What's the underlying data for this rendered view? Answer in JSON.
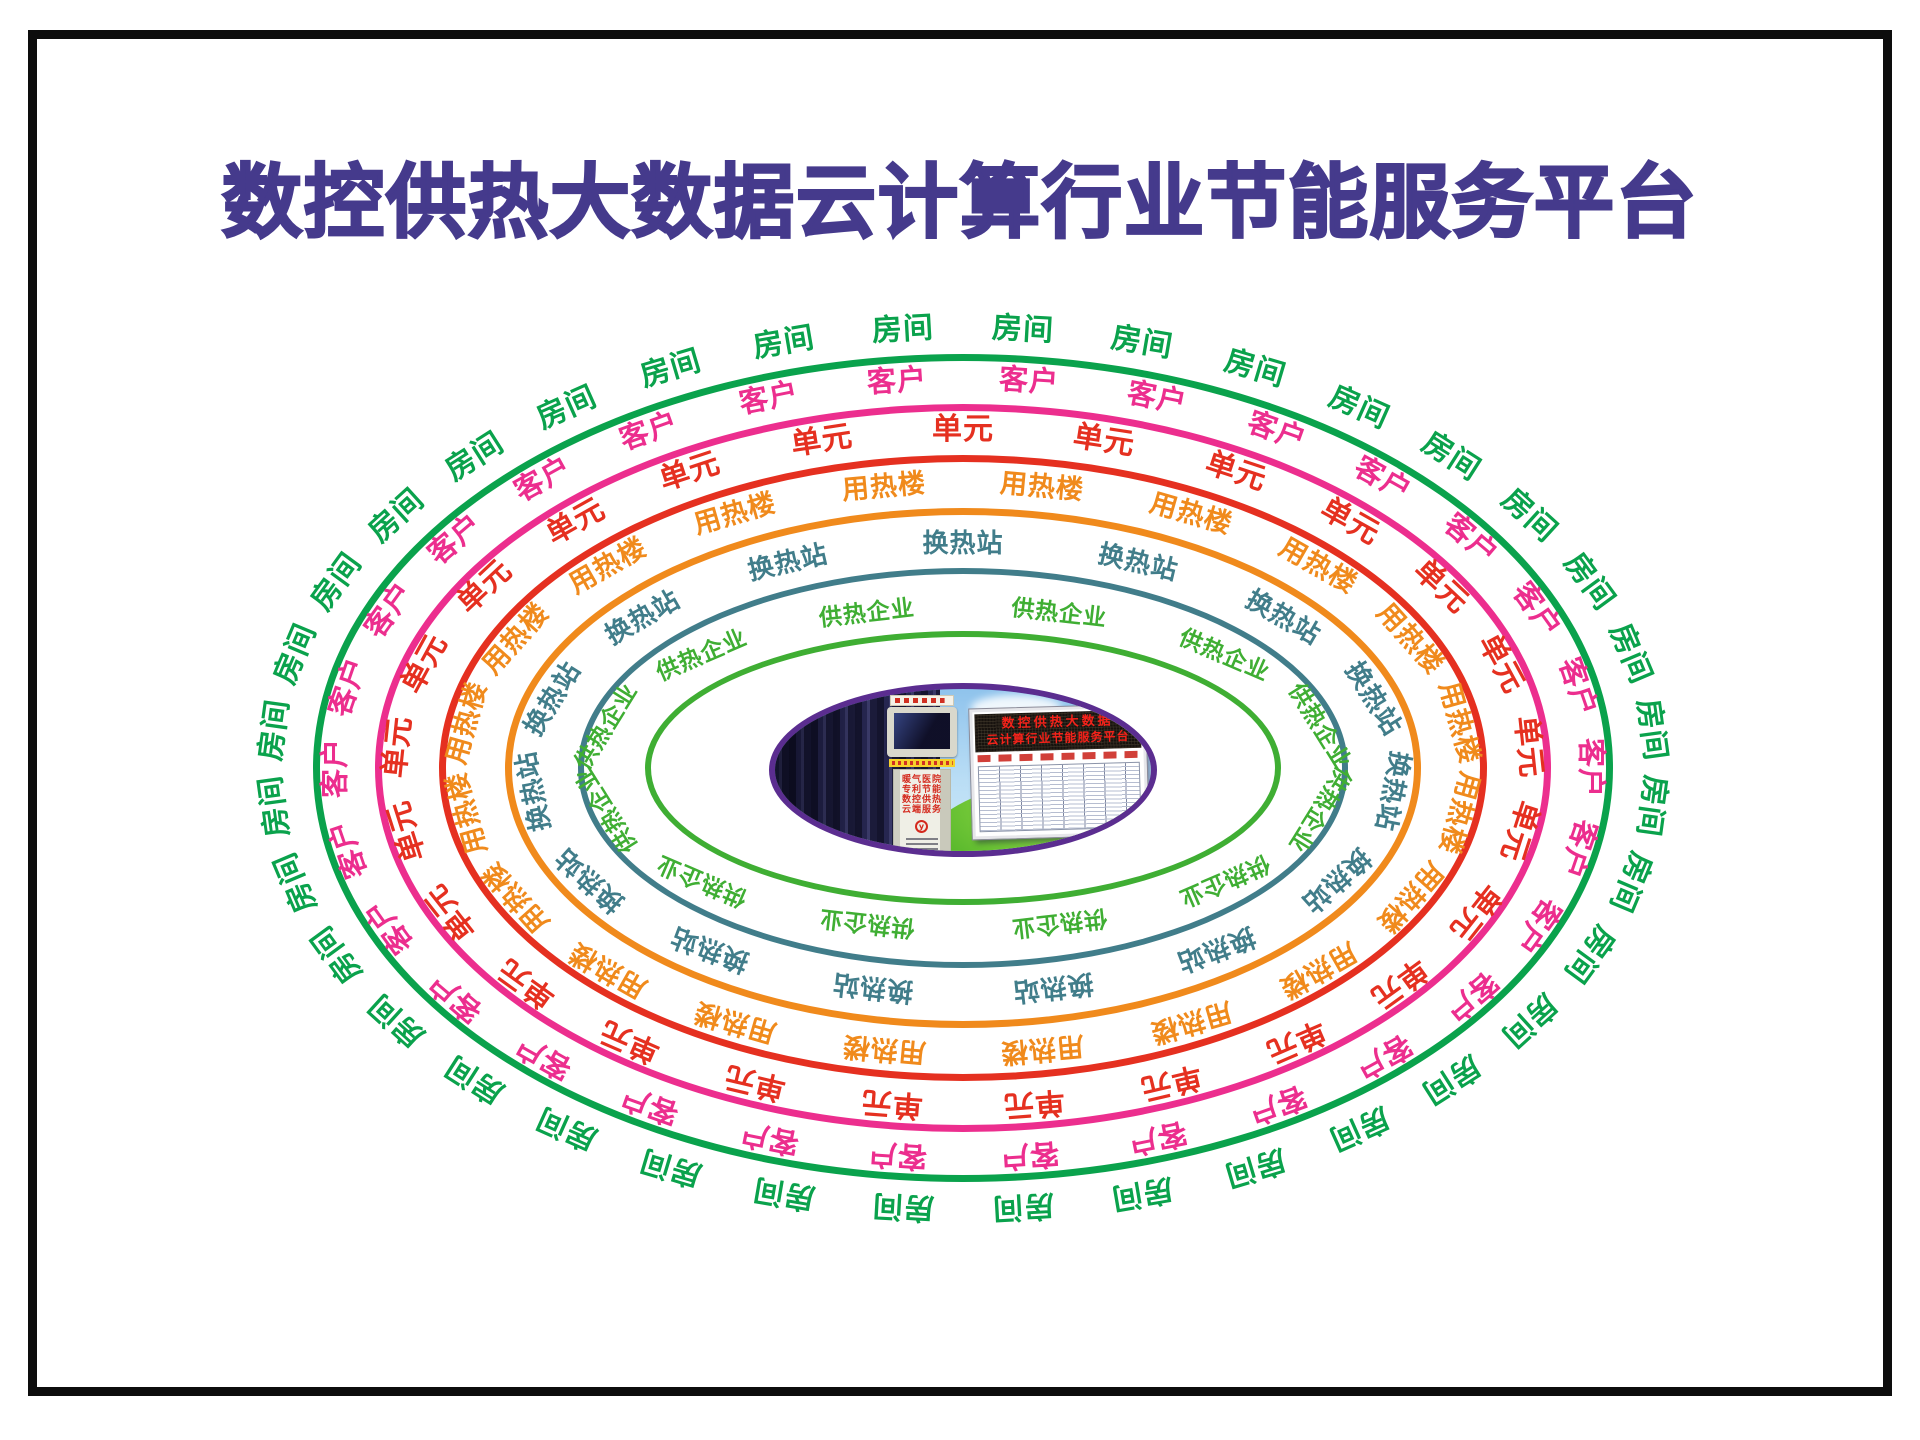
{
  "title": "数控供热大数据云计算行业节能服务平台",
  "colors": {
    "title": "#453a8c",
    "frame": "#0d0d0d",
    "center_border": "#5b2d90",
    "led_text": "#f5221a",
    "kiosk_text": "#d42a1e"
  },
  "rings": [
    {
      "label": "房间",
      "color": "#0aa24c",
      "a": 650,
      "b": 414,
      "count": 36,
      "font": 30,
      "phase": 0.5,
      "offset": 26,
      "stroke": 7
    },
    {
      "label": "客户",
      "color": "#ec2e8e",
      "a": 588,
      "b": 364,
      "count": 30,
      "font": 29,
      "phase": 0.5,
      "offset": 25,
      "stroke": 7
    },
    {
      "label": "单元",
      "color": "#e53020",
      "a": 524,
      "b": 313,
      "count": 25,
      "font": 30,
      "phase": 0.0,
      "offset": 25,
      "stroke": 7
    },
    {
      "label": "用热楼",
      "color": "#f08a1c",
      "a": 458,
      "b": 260,
      "count": 20,
      "font": 27,
      "phase": 0.5,
      "offset": 25,
      "stroke": 7
    },
    {
      "label": "换热站",
      "color": "#417d8a",
      "a": 385,
      "b": 200,
      "count": 15,
      "font": 26,
      "phase": 0.0,
      "offset": 24,
      "stroke": 6
    },
    {
      "label": "供热企业",
      "color": "#3fae33",
      "a": 318,
      "b": 137,
      "count": 12,
      "font": 23,
      "phase": 0.5,
      "offset": 22,
      "stroke": 6
    }
  ],
  "center": {
    "cx": 963,
    "cy": 770,
    "led_line1": "数控供热大数据",
    "led_line2": "云计算行业节能服务平台",
    "kiosk_lines": [
      "暖气医院",
      "专利节能",
      "数控供热",
      "云端服务"
    ],
    "kiosk_emblem_glyph": "y"
  }
}
